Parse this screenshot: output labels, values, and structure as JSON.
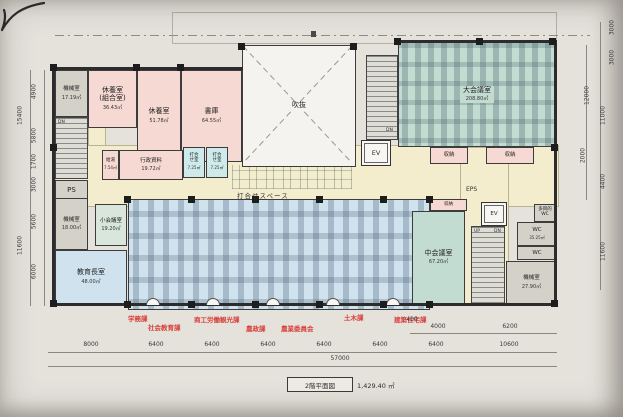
{
  "meta": {
    "drawing_title": "2階平面図",
    "total_area": "1,429.40 ㎡"
  },
  "labels": {
    "void": "吹抜",
    "meeting_space": "打合せスペース",
    "eps": "EPS",
    "ps": "PS",
    "ev": "EV",
    "dn": "DN",
    "up": "UP"
  },
  "rooms": [
    {
      "name": "機械室",
      "area": "17.19㎡"
    },
    {
      "name": "休養室\n(組合室)",
      "area": "36.43㎡"
    },
    {
      "name": "休養室",
      "area": "51.78㎡"
    },
    {
      "name": "書庫",
      "area": "64.55㎡"
    },
    {
      "name": "給湯",
      "area": "7.54㎡"
    },
    {
      "name": "行政資料",
      "area": "19.72㎡"
    },
    {
      "name": "打合\nせ室",
      "area": "7.25㎡"
    },
    {
      "name": "打合\nせ室",
      "area": "7.25㎡"
    },
    {
      "name": "大会議室",
      "area": "208.80㎡"
    },
    {
      "name": "収納",
      "area": ""
    },
    {
      "name": "収納",
      "area": ""
    },
    {
      "name": "収納",
      "area": ""
    },
    {
      "name": "機械室",
      "area": "18.00㎡"
    },
    {
      "name": "小会議室",
      "area": "19.20㎡"
    },
    {
      "name": "教育長室",
      "area": "48.00㎡"
    },
    {
      "name": "中会議室",
      "area": "67.20㎡"
    },
    {
      "name": "多目的\nWC",
      "area": ""
    },
    {
      "name": "WC",
      "area": "35.25㎡"
    },
    {
      "name": "WC",
      "area": ""
    },
    {
      "name": "機械室",
      "area": "27.90㎡"
    }
  ],
  "departments": [
    "学務課",
    "社会教育課",
    "商工労働観光課",
    "農政課",
    "農業委員会",
    "土木課",
    "建築住宅課"
  ],
  "dims": {
    "left": [
      "4900",
      "15400",
      "5800",
      "1700",
      "3000",
      "5600",
      "11600",
      "6000"
    ],
    "right": [
      "3000",
      "3000",
      "12000",
      "11000",
      "2000",
      "4400",
      "11600"
    ],
    "bottom": [
      "8000",
      "6400",
      "6400",
      "6400",
      "6400",
      "6400",
      "6400",
      "10600"
    ],
    "bottom_sub": [
      "400",
      "4000",
      "6200"
    ],
    "bottom_total": "57000"
  },
  "colors": {
    "room_pink": "#f6d9d2",
    "room_teal": "#c3dcd1",
    "room_blue": "#cfe2ee",
    "room_gray": "#d4d1c8",
    "room_green": "#d9e7da",
    "room_cyan": "#cfeaea",
    "corridor_yellow": "#f3edcd",
    "department_text_red": "#d8403c"
  }
}
